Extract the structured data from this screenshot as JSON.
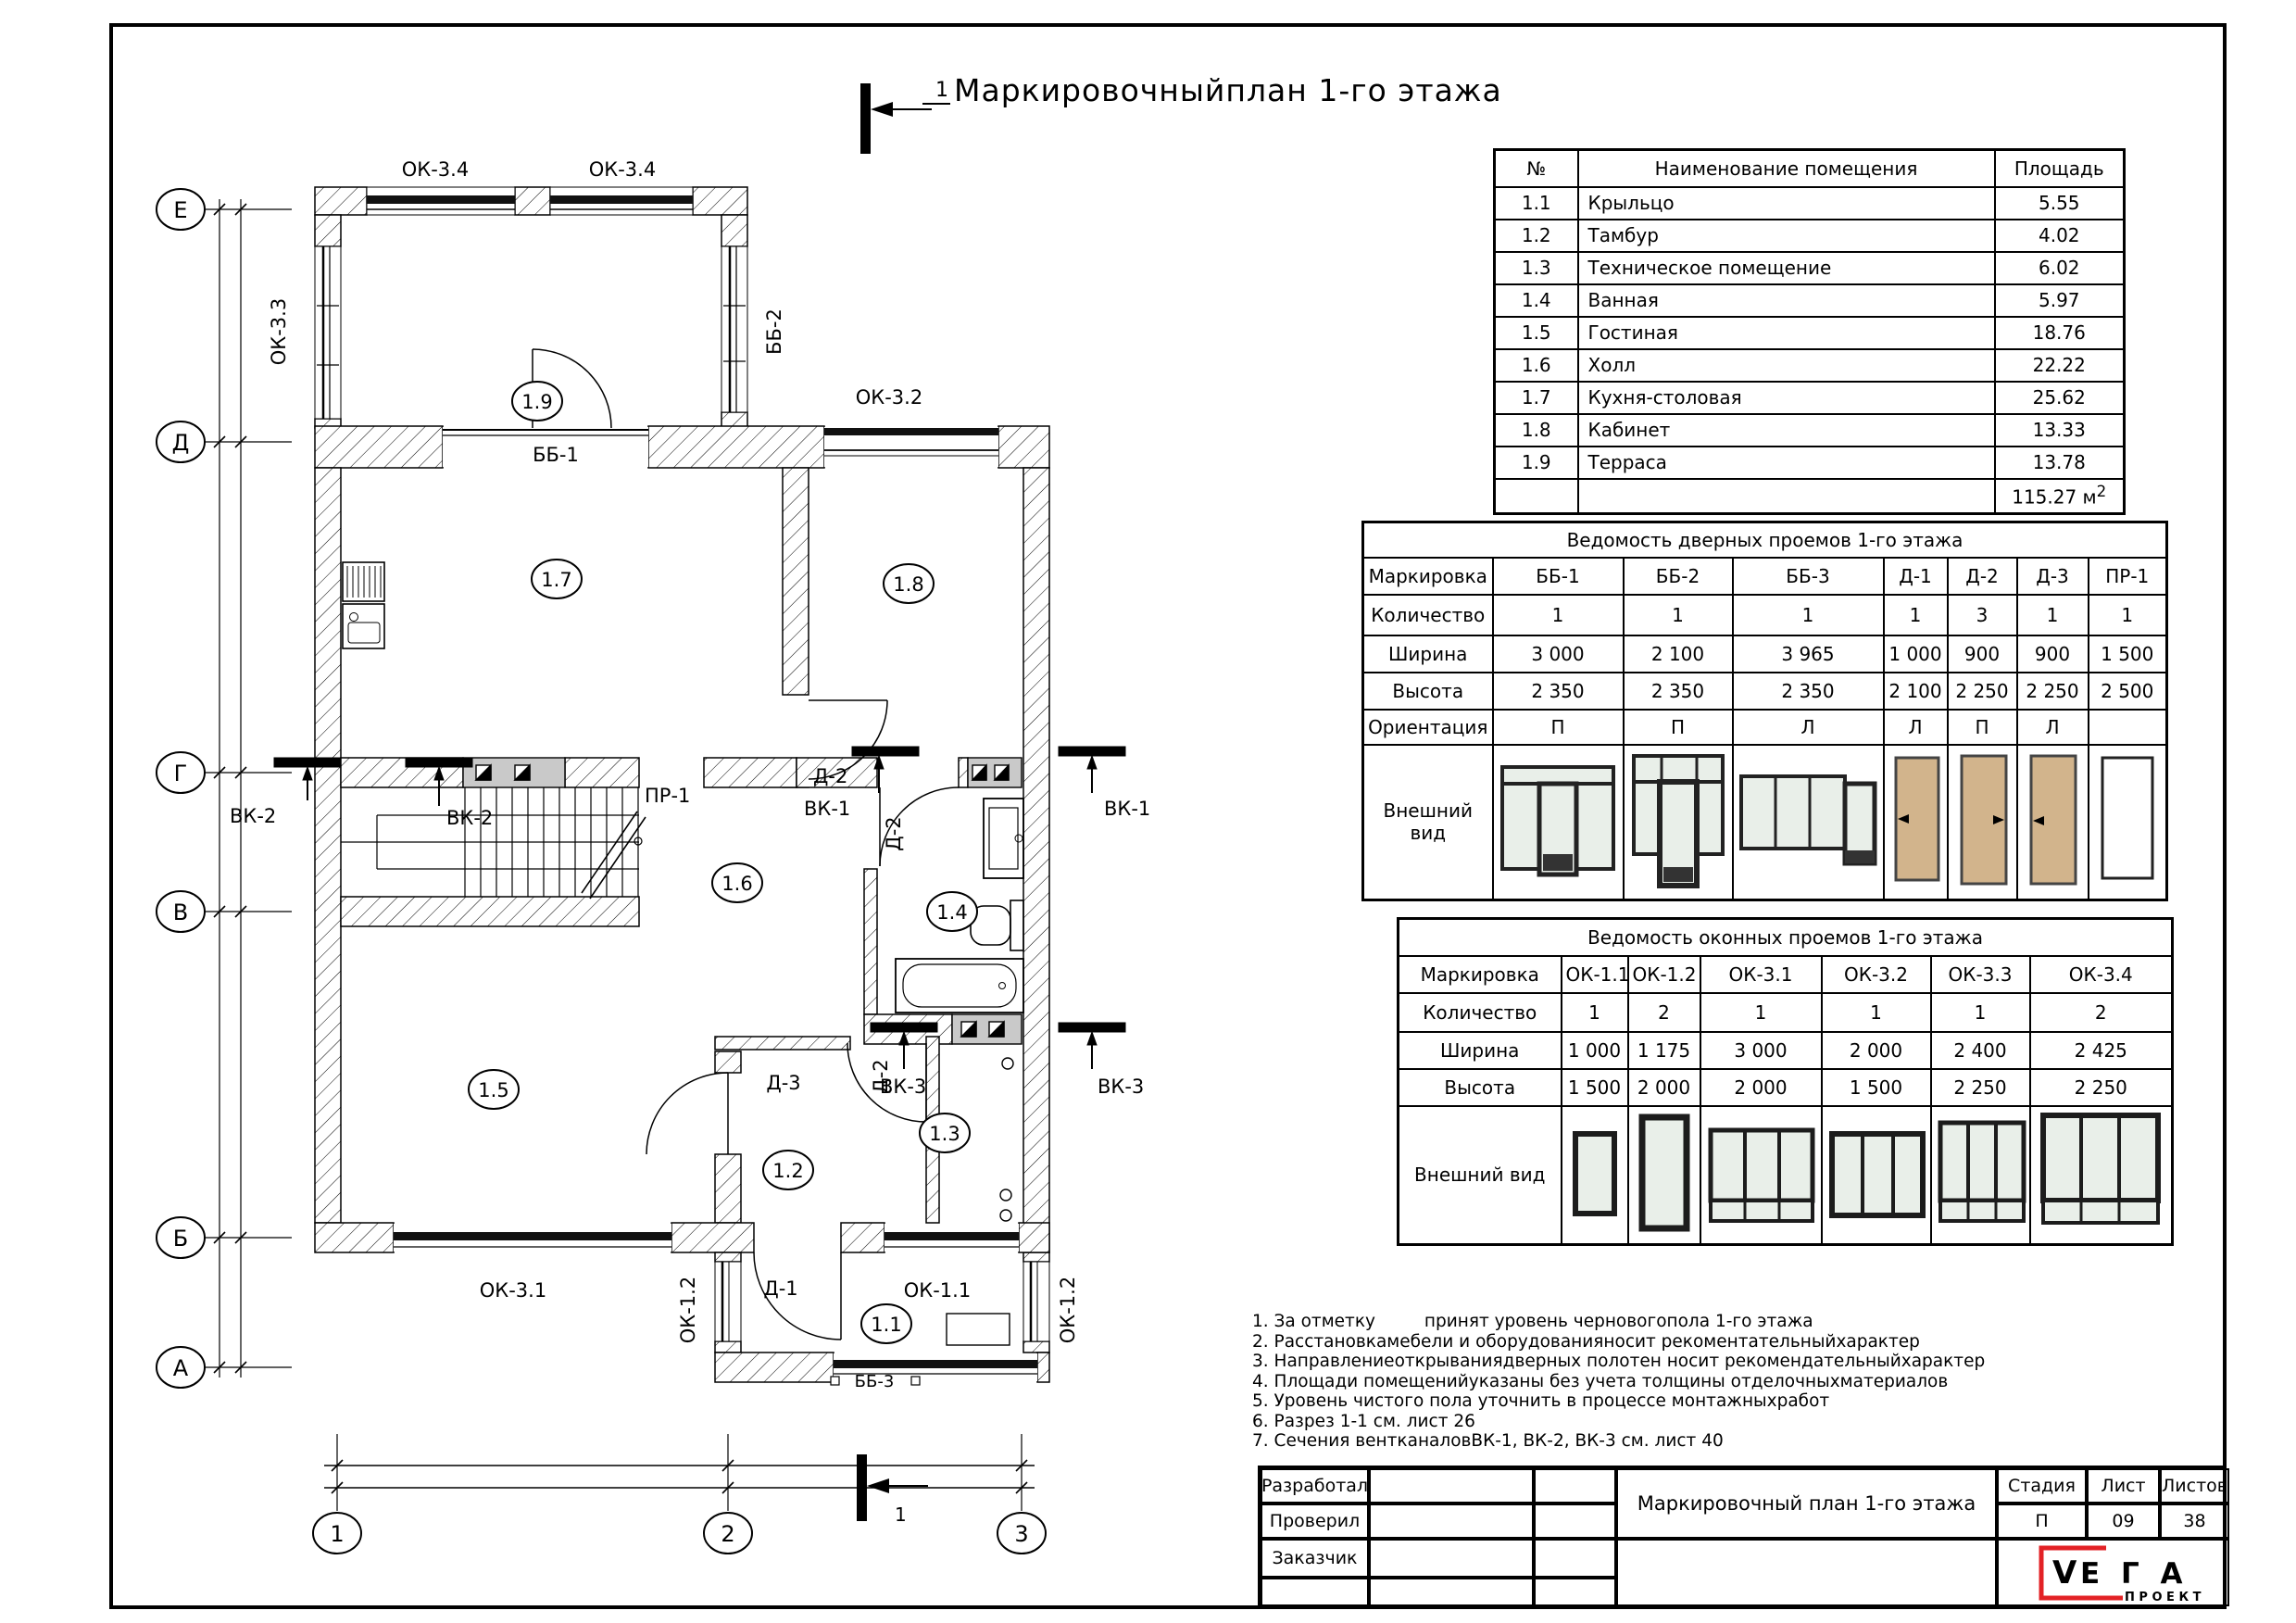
{
  "sheet": {
    "title": "Маркировочныйплан 1-го этажа",
    "section_mark": "1"
  },
  "colors": {
    "brand_red": "#e32226",
    "door_tan": "#d2b48c",
    "glass": "#e9efe9",
    "vent_gray": "#c9c9c9"
  },
  "plan": {
    "axes_rows": [
      "Е",
      "Д",
      "Г",
      "В",
      "Б",
      "А"
    ],
    "axes_cols": [
      "1",
      "2",
      "3"
    ],
    "rooms": {
      "r11": "1.1",
      "r12": "1.2",
      "r13": "1.3",
      "r14": "1.4",
      "r15": "1.5",
      "r16": "1.6",
      "r17": "1.7",
      "r18": "1.8",
      "r19": "1.9"
    },
    "labels": {
      "ok34a": "ОК-3.4",
      "ok34b": "ОК-3.4",
      "ok33": "ОК-3.3",
      "bb2": "ББ-2",
      "ok32": "ОК-3.2",
      "bb1": "ББ-1",
      "pr1": "ПР-1",
      "vk2a": "ВК-2",
      "vk2b": "ВК-2",
      "vk1a": "ВК-1",
      "vk1b": "ВК-1",
      "vk3a": "ВК-3",
      "vk3b": "ВК-3",
      "d2a": "Д-2",
      "d2b": "Д-2",
      "d2c": "Д-2",
      "d3": "Д-3",
      "d1": "Д-1",
      "ok31": "ОК-3.1",
      "ok11": "ОК-1.1",
      "ok12a": "ОК-1.2",
      "ok12b": "ОК-1.2",
      "bb3": "ББ-3"
    }
  },
  "room_table": {
    "headers": [
      "№",
      "Наименование помещения",
      "Площадь"
    ],
    "rows": [
      [
        "1.1",
        "Крыльцо",
        "5.55"
      ],
      [
        "1.2",
        "Тамбур",
        "4.02"
      ],
      [
        "1.3",
        "Техническое помещение",
        "6.02"
      ],
      [
        "1.4",
        "Ванная",
        "5.97"
      ],
      [
        "1.5",
        "Гостиная",
        "18.76"
      ],
      [
        "1.6",
        "Холл",
        "22.22"
      ],
      [
        "1.7",
        "Кухня-столовая",
        "25.62"
      ],
      [
        "1.8",
        "Кабинет",
        "13.33"
      ],
      [
        "1.9",
        "Терраса",
        "13.78"
      ]
    ],
    "total": "115.27 м",
    "total_sup": "2"
  },
  "door_table": {
    "title": "Ведомость дверных проемов 1-го этажа",
    "row_labels": [
      "Маркировка",
      "Количество",
      "Ширина",
      "Высота",
      "Ориентация",
      "Внешний вид"
    ],
    "marks": [
      "ББ-1",
      "ББ-2",
      "ББ-3",
      "Д-1",
      "Д-2",
      "Д-3",
      "ПР-1"
    ],
    "qty": [
      "1",
      "1",
      "1",
      "1",
      "3",
      "1",
      "1"
    ],
    "width": [
      "3 000",
      "2 100",
      "3 965",
      "1 000",
      "900",
      "900",
      "1 500"
    ],
    "height": [
      "2 350",
      "2 350",
      "2 350",
      "2 100",
      "2 250",
      "2 250",
      "2 500"
    ],
    "orientation": [
      "П",
      "П",
      "Л",
      "Л",
      "П",
      "Л",
      ""
    ]
  },
  "window_table": {
    "title": "Ведомость оконных проемов 1-го этажа",
    "row_labels": [
      "Маркировка",
      "Количество",
      "Ширина",
      "Высота",
      "Внешний вид"
    ],
    "marks": [
      "ОК-1.1",
      "ОК-1.2",
      "ОК-3.1",
      "ОК-3.2",
      "ОК-3.3",
      "ОК-3.4"
    ],
    "qty": [
      "1",
      "2",
      "1",
      "1",
      "1",
      "2"
    ],
    "width": [
      "1 000",
      "1 175",
      "3 000",
      "2 000",
      "2 400",
      "2 425"
    ],
    "height": [
      "1 500",
      "2 000",
      "2 000",
      "1 500",
      "2 250",
      "2 250"
    ]
  },
  "notes": [
    "1. За отметку         принят уровень черновогопола 1-го этажа",
    "2. Расстановкамебели и  оборудованияносит рекоментательныйхарактер",
    "3. Направлениеоткрываниядверных полотен носит рекомендательныйхарактер",
    "4. Площади помещенийуказаны без учета толщины отделочныхматериалов",
    "5. Уровень чистого пола уточнить в  процессе монтажныхработ",
    "6. Разрез 1-1 см. лист 26",
    "7. Сечения вентканаловВК-1, ВК-2, ВК-3 см. лист 40"
  ],
  "title_block": {
    "row_labels": [
      "Разработал",
      "Проверил",
      "Заказчик"
    ],
    "doc_title": "Маркировочный план 1-го этажа",
    "stage_label": "Стадия",
    "sheet_label": "Лист",
    "sheets_label": "Листов",
    "stage": "П",
    "sheet": "09",
    "sheets": "38",
    "logo": {
      "v": "V",
      "ega": "Е Г А",
      "sub": "П Р О Е К Т",
      "red": "#e32226"
    }
  }
}
